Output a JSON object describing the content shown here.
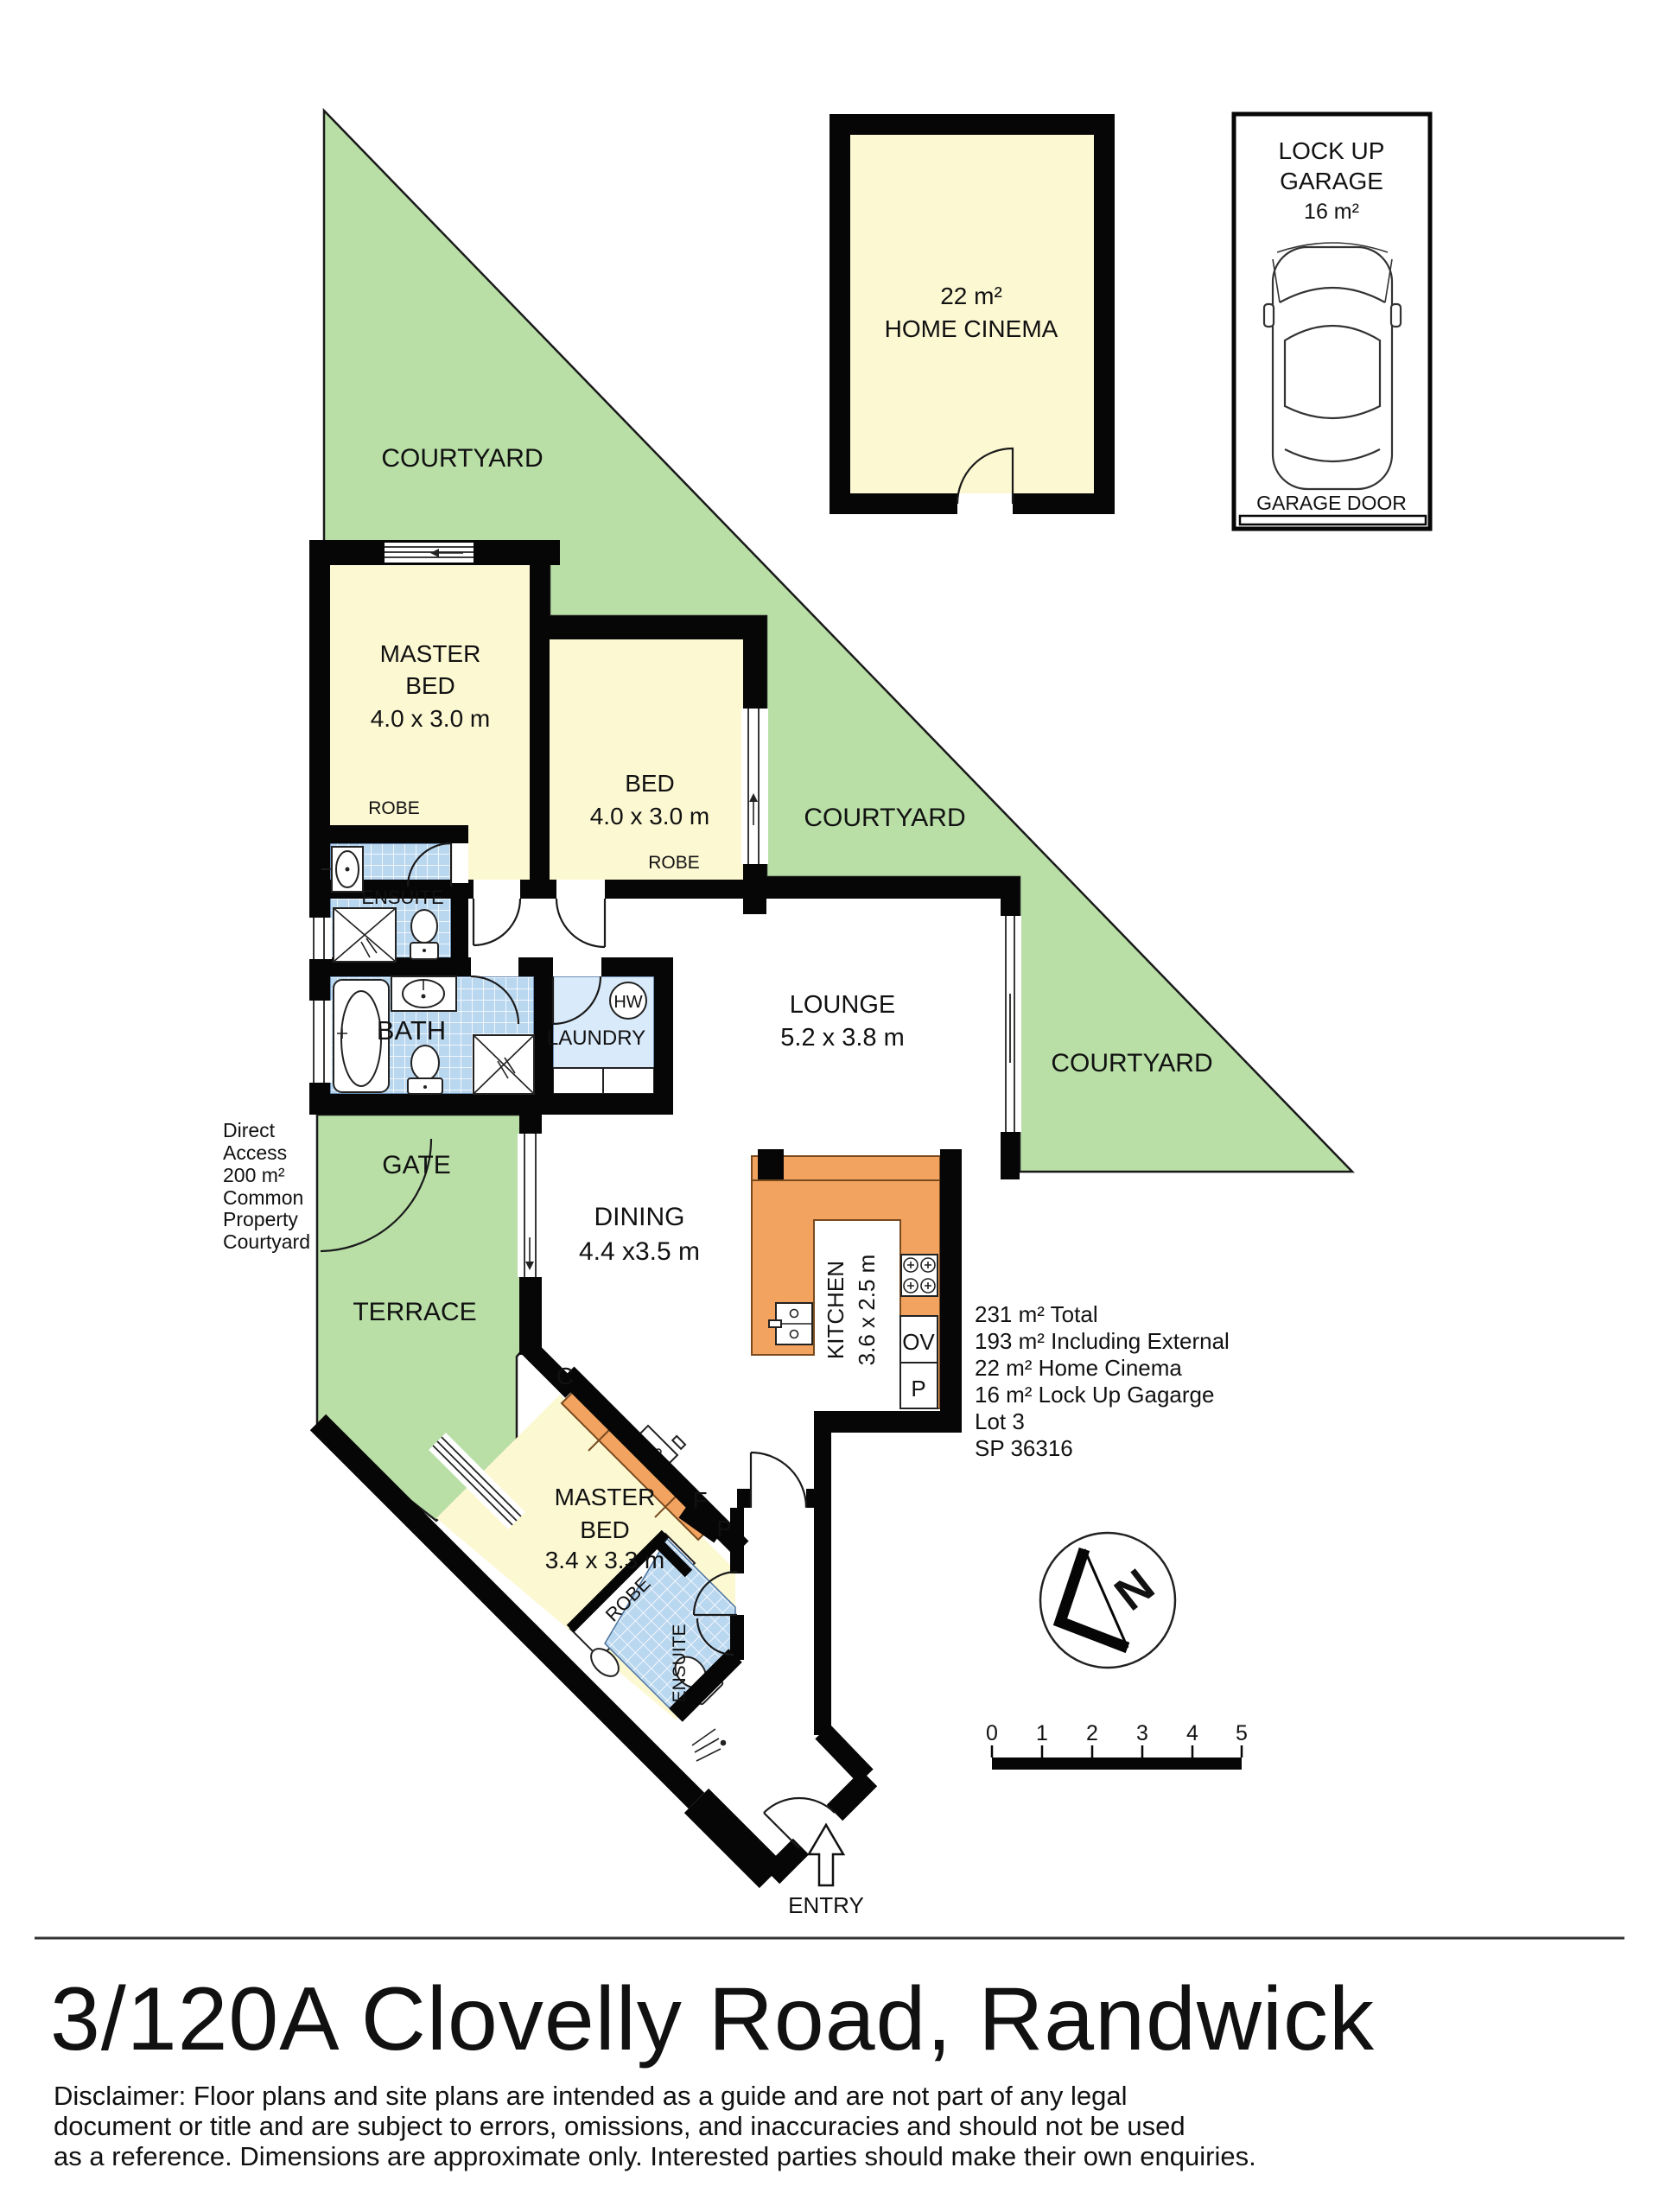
{
  "title": "3/120A Clovelly Road, Randwick",
  "disclaimer": [
    "Disclaimer: Floor plans and site plans are intended as a guide and are not part of any legal",
    "document or title and are subject to errors, omissions, and inaccuracies and should not be used",
    "as a reference. Dimensions are approximate only. Interested parties should make their own enquiries."
  ],
  "rooms": {
    "home_cinema": {
      "area": "22 m²",
      "name": "HOME CINEMA"
    },
    "garage": {
      "name_line1": "LOCK UP",
      "name_line2": "GARAGE",
      "area": "16 m²",
      "door": "GARAGE DOOR"
    },
    "master_bed_upper": {
      "name_line1": "MASTER",
      "name_line2": "BED",
      "dims": "4.0 x 3.0 m"
    },
    "bed": {
      "name": "BED",
      "dims": "4.0 x 3.0 m"
    },
    "lounge": {
      "name": "LOUNGE",
      "dims": "5.2 x 3.8 m"
    },
    "dining": {
      "name": "DINING",
      "dims": "4.4 x3.5 m"
    },
    "kitchen": {
      "name": "KITCHEN",
      "dims": "3.6 x 2.5 m"
    },
    "master_bed_lower": {
      "name_line1": "MASTER",
      "name_line2": "BED",
      "dims": "3.4 x 3.3 m"
    },
    "bath": {
      "name": "BATH"
    },
    "laundry": {
      "name": "LAUNDRY"
    },
    "ensuite_upper": {
      "name": "ENSUITE"
    },
    "ensuite_lower": {
      "name": "ENSUITE"
    },
    "robe_master_upper": {
      "name": "ROBE"
    },
    "robe_bed": {
      "name": "ROBE"
    },
    "robe_master_lower": {
      "name": "ROBE"
    }
  },
  "outdoor": {
    "courtyard_upper": "COURTYARD",
    "courtyard_middle": "COURTYARD",
    "courtyard_right": "COURTYARD",
    "gate": "GATE",
    "terrace": "TERRACE",
    "entry": "ENTRY",
    "direct_access": [
      "Direct",
      "Access",
      "200 m²",
      "Common",
      "Property",
      "Courtyard"
    ]
  },
  "appliances": {
    "hot_water": "HW",
    "oven": "OV",
    "pantry": "P",
    "fridge": "F",
    "pantry2": "P",
    "cupboard": "C"
  },
  "summary": [
    "231 m² Total",
    "193 m² Including External",
    "22 m² Home Cinema",
    "16 m² Lock Up Gagarge",
    "Lot 3",
    "SP 36316"
  ],
  "compass": {
    "north": "N"
  },
  "scale_bar": {
    "ticks": [
      "0",
      "1",
      "2",
      "3",
      "4",
      "5"
    ]
  },
  "colors": {
    "courtyard": "#b9dfa7",
    "room_yellow": "#fcf8d2",
    "kitchen_orange": "#f2a360",
    "laundry_blue": "#d9eafa",
    "tile_blue": "#bad7f0",
    "wall": "#060606"
  }
}
